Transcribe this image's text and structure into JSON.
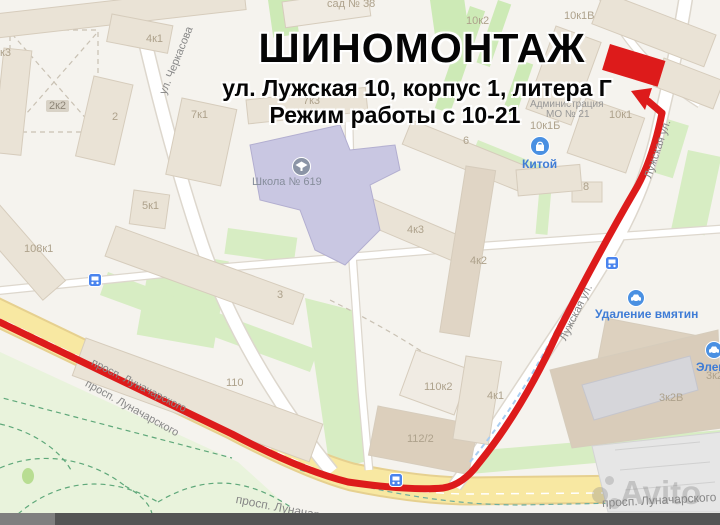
{
  "ad": {
    "title": "ШИНОМОНТАЖ",
    "address": "ул. Лужская 10, корпус 1, литера Г",
    "hours": "Режим работы с 10-21"
  },
  "streets": {
    "cherkasova": "ул. Черкасова",
    "luzhskaya": "Лужская ул.",
    "lunacharskogo": "просп. Луначарского"
  },
  "buildings": {
    "k3": "к3",
    "b4k1_nw": "4к1",
    "b2k2": "2к2",
    "b2": "2",
    "b7k1": "7к1",
    "b7k3": "7к3",
    "b5k1": "5к1",
    "b108k1": "108к1",
    "sad38": "сад № 38",
    "b10k2": "10к2",
    "b10k1v": "10к1В",
    "b10k1b": "10к1Б",
    "b10k1": "10к1",
    "b8": "8",
    "b6": "6",
    "b4k3": "4к3",
    "b4k2": "4к2",
    "b3": "3",
    "b110": "110",
    "b110k2": "110к2",
    "b112_2": "112/2",
    "b4k1_se": "4к1",
    "b3k2v": "3к2В",
    "b3k2": "3к2"
  },
  "pois": {
    "school": "Школа № 619",
    "admin_line1": "Администрация",
    "admin_line2": "МО № 21",
    "kitoy": "Китой",
    "dent_removal": "Удаление вмятин",
    "element": "Элемент"
  },
  "watermark": "Avito",
  "colors": {
    "route_red": "#dd1b1b",
    "road_yellow": "#f8e8a2",
    "park_green": "#e9f3dc",
    "lawn_green": "#d7edc3",
    "building_tan": "#eae3d6",
    "school_purple": "#c9c7e2",
    "poi_blue": "#3f7cd6"
  }
}
